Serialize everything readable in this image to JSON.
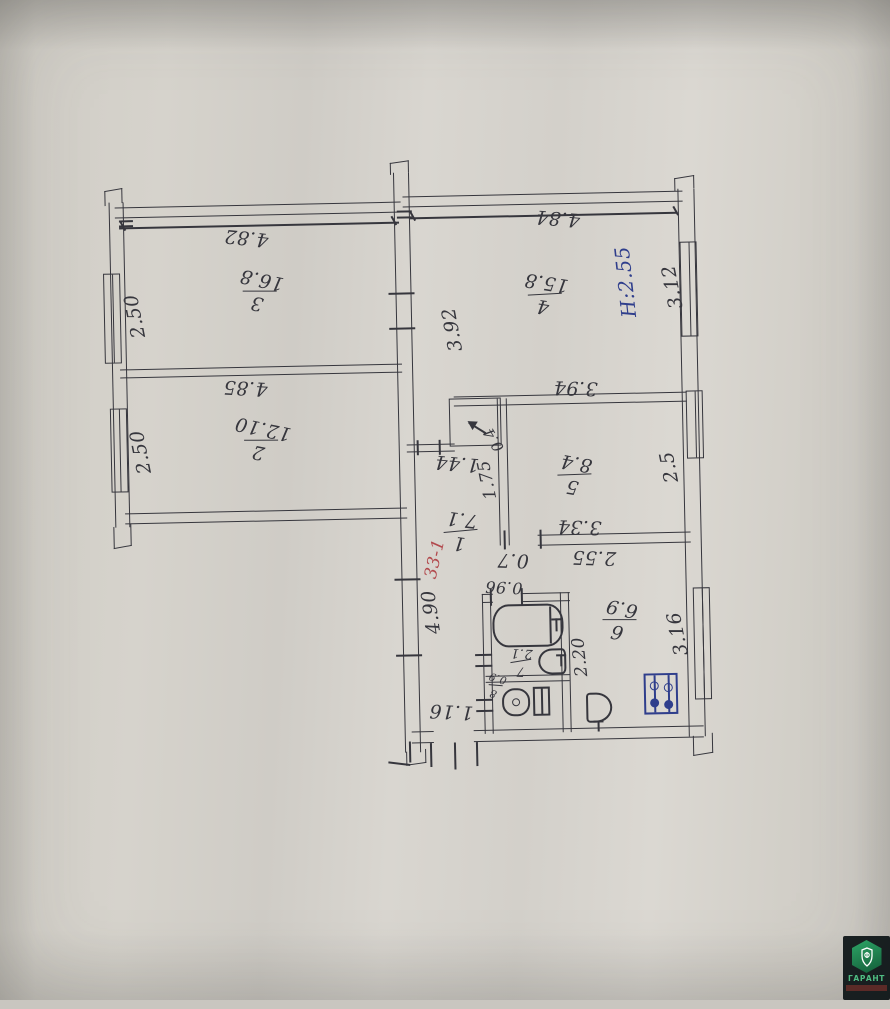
{
  "rooms": {
    "r1": {
      "num": "1",
      "area": "7.1"
    },
    "r2": {
      "num": "2",
      "area": "12.10"
    },
    "r3": {
      "num": "3",
      "area": "16.8"
    },
    "r4": {
      "num": "4",
      "area": "15.8"
    },
    "r5": {
      "num": "5",
      "area": "8.4"
    },
    "r6": {
      "num": "6",
      "area": "6.9"
    },
    "r7": {
      "num": "7",
      "area": "2.1"
    },
    "r8": {
      "num": "8",
      "area": "0.9"
    }
  },
  "dims": {
    "room3_width": "4.82",
    "room2_width": "4.85",
    "room4_width": "4.84",
    "window_left_top": "2.50",
    "window_left_bottom": "2.50",
    "window_right_top": "3.12",
    "window_right_mid": "2.5",
    "window_right_bottom": "3.16",
    "inner_392": "3.92",
    "room5_top": "3.94",
    "room5_bottom": "3.34",
    "kitchen_width": "2.55",
    "kitchen_door": "0.7",
    "hall_width": "1.44",
    "hall_depth": "1.75",
    "closet_area": "0.4",
    "corridor_length": "4.90",
    "bath_door": "0.96",
    "bath_depth": "2.20",
    "entrance_width": "1.16"
  },
  "notes": {
    "height": "H:2.55",
    "apartment": "33-1"
  },
  "watermark": {
    "brand": "ГАРАНТ"
  }
}
